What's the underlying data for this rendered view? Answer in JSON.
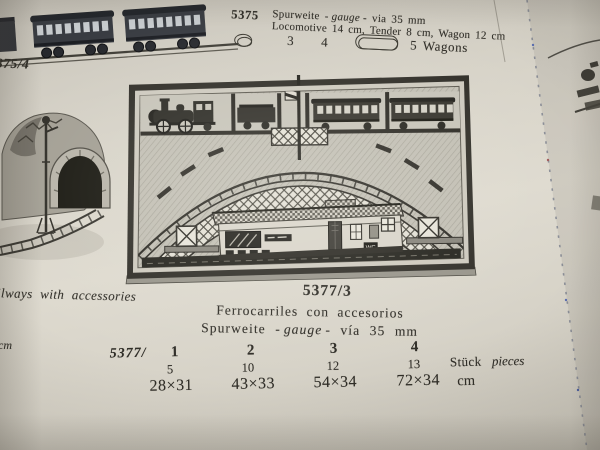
{
  "colors": {
    "paper": "#d9d5ca",
    "ink": "#2f2d27"
  },
  "top_section": {
    "catalog_number": "5375",
    "line1_pre": "Spurweite -",
    "line1_italic": "gauge",
    "line1_post": "- via 35 mm",
    "line2": "Locomotive 14 cm, Tender 8 cm, Wagon 12 cm",
    "count1": "3",
    "count2": "4",
    "wagons_label": "5 Wagons"
  },
  "left_margin": {
    "page_label": "375/4",
    "fragment_text": "ilways with accessories",
    "fragment_unit": "cm"
  },
  "product": {
    "number": "5377/3",
    "title_es": "Ferrocarriles con accesorios",
    "gauge_pre": "Spurweite -",
    "gauge_italic": "gauge",
    "gauge_post": "- vía 35 mm"
  },
  "table": {
    "prefix": "5377/",
    "variants": [
      "1",
      "2",
      "3",
      "4"
    ],
    "pieces": [
      "5",
      "10",
      "12",
      "13"
    ],
    "pieces_label": "Stück",
    "pieces_label_en": "pieces",
    "dimensions": [
      "28×31",
      "43×33",
      "54×34",
      "72×34"
    ],
    "unit": "cm"
  },
  "illustrations": {
    "station_sign": "WC",
    "top_left": "passenger-wagons-on-track",
    "left": "tunnel-with-curved-track-and-signal",
    "center": "boxed-train-set-with-viaduct-arches-and-station"
  }
}
